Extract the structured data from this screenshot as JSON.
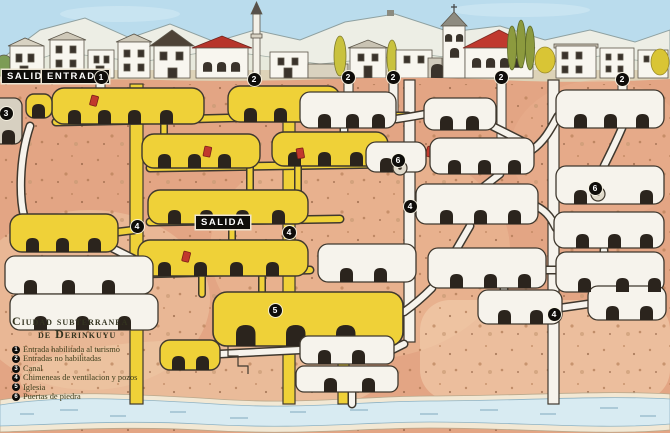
{
  "title": {
    "line1": "Ciudad subterranea",
    "line2": "de Derinkuyu"
  },
  "surface_labels": {
    "salida": "SALIDA",
    "entrada": "ENTRADA",
    "salida_mid": "SALIDA"
  },
  "legend": {
    "items": [
      {
        "num": "1",
        "text": "Entrada habilitada al turismo"
      },
      {
        "num": "2",
        "text": "Entradas no habilitadas"
      },
      {
        "num": "3",
        "text": "Canal"
      },
      {
        "num": "4",
        "text": "Chimeneas de ventilacion y pozos"
      },
      {
        "num": "5",
        "text": "Iglesia"
      },
      {
        "num": "6",
        "text": "Puertas de piedra"
      }
    ]
  },
  "markers": [
    {
      "num": "1",
      "x": 101,
      "y": 77
    },
    {
      "num": "2",
      "x": 254,
      "y": 79
    },
    {
      "num": "2",
      "x": 348,
      "y": 77
    },
    {
      "num": "2",
      "x": 393,
      "y": 77
    },
    {
      "num": "2",
      "x": 501,
      "y": 77
    },
    {
      "num": "2",
      "x": 622,
      "y": 79
    },
    {
      "num": "3",
      "x": 6,
      "y": 113
    },
    {
      "num": "4",
      "x": 137,
      "y": 226
    },
    {
      "num": "4",
      "x": 289,
      "y": 232
    },
    {
      "num": "4",
      "x": 410,
      "y": 206
    },
    {
      "num": "4",
      "x": 554,
      "y": 314
    },
    {
      "num": "5",
      "x": 275,
      "y": 310
    },
    {
      "num": "6",
      "x": 398,
      "y": 160
    },
    {
      "num": "6",
      "x": 595,
      "y": 188
    }
  ],
  "colors": {
    "sky": "#badced",
    "mountain": "#edeee5",
    "earth": "#e3a584",
    "earth_light": "#f0cba8",
    "tunnel_yellow": "#efd138",
    "chamber_white": "#f6f3ec",
    "outline": "#3f382e",
    "water": "#d8ebf2",
    "roof_red": "#c0392e",
    "stone_door_red": "#c1392d",
    "label_bg": "#0f0d0a",
    "label_fg": "#ffffff",
    "legend_text": "#3e3e1c"
  }
}
